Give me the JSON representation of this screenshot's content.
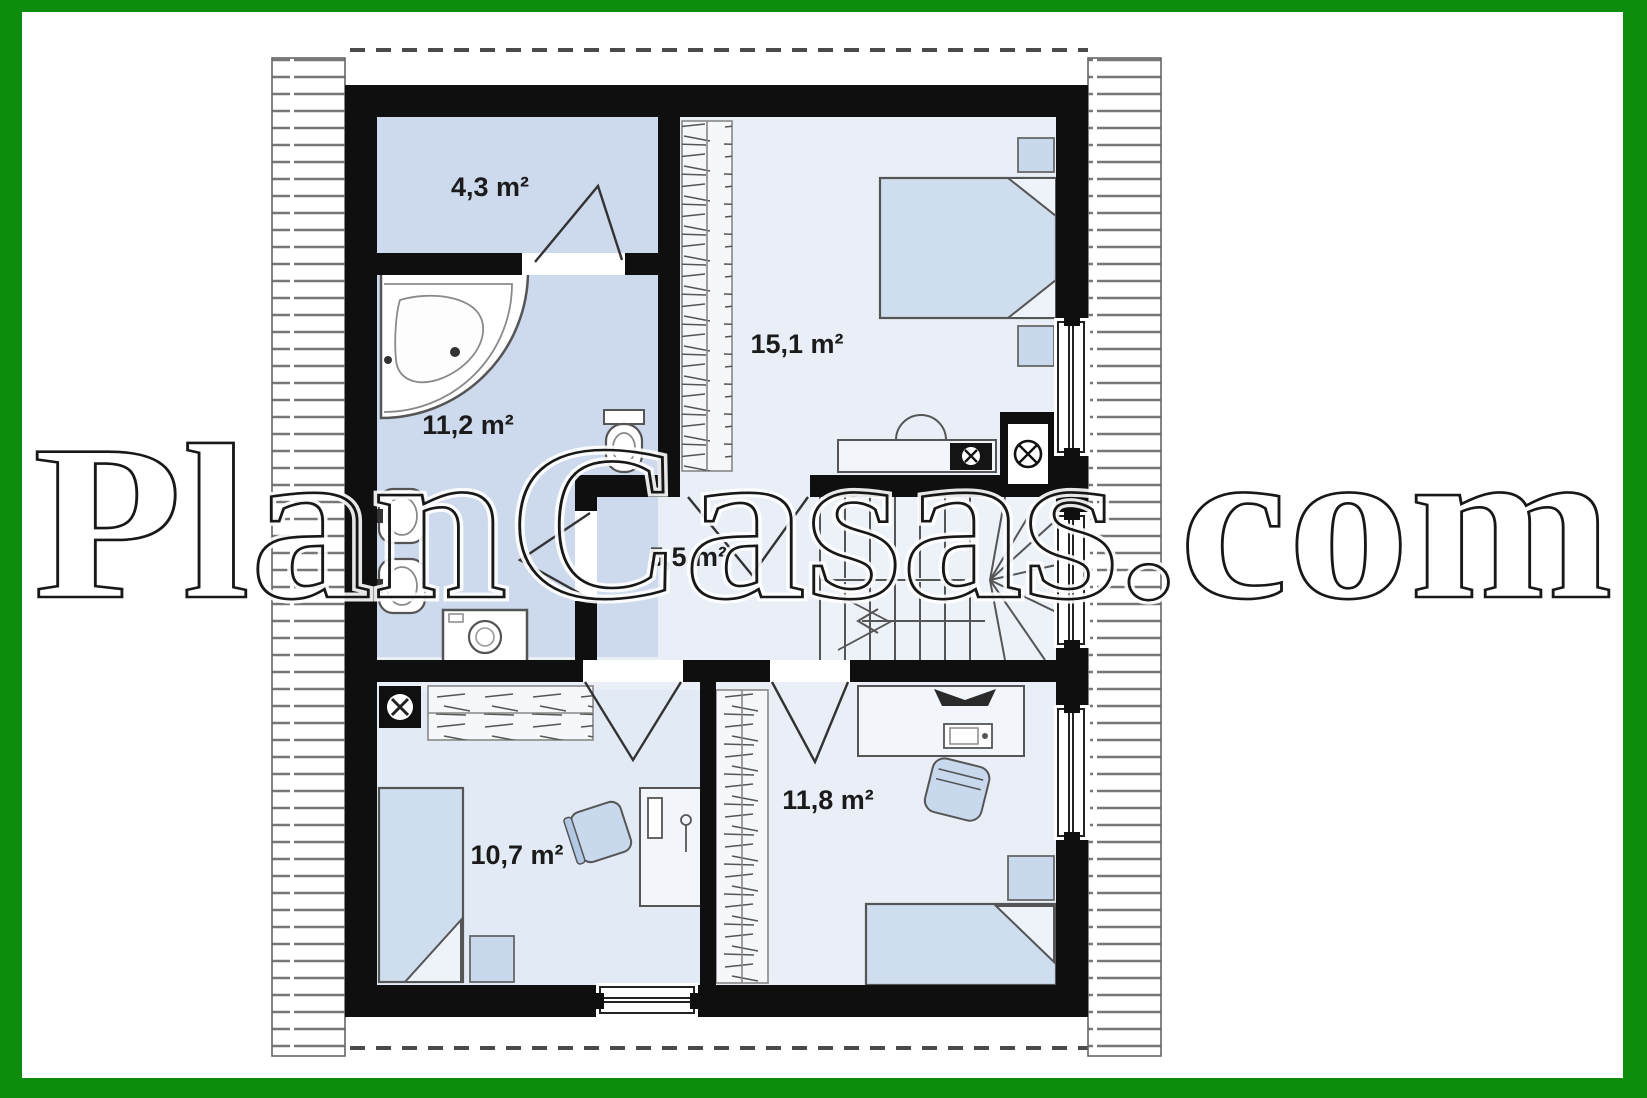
{
  "border": {
    "color": "#0e8c0e"
  },
  "watermark": {
    "text": "PlanCasas.com"
  },
  "plan": {
    "type": "floor-plan",
    "wall_color": "#0f0f0f",
    "room_fill": "#cdd9ec",
    "room_fill_light": "#e9eef7",
    "furniture_fill": "#c9d9ed",
    "rooms": [
      {
        "name": "toilet-room",
        "area": "4,3 m²"
      },
      {
        "name": "bathroom",
        "area": "11,2 m²"
      },
      {
        "name": "bedroom-main",
        "area": "15,1 m²"
      },
      {
        "name": "hall-landing",
        "area": "5,5 m²"
      },
      {
        "name": "bedroom-left",
        "area": "10,7 m²"
      },
      {
        "name": "bedroom-right",
        "area": "11,8 m²"
      }
    ],
    "icons": [
      "corner-bathtub-icon",
      "sink-icon",
      "toilet-icon",
      "washing-machine-icon",
      "double-bed-icon",
      "single-bed-icon",
      "nightstand-icon",
      "desk-icon",
      "office-chair-icon",
      "armchair-icon",
      "wardrobe-icon",
      "stairs-icon",
      "chimney-icon",
      "vent-icon",
      "window-icon",
      "door-icon"
    ]
  }
}
